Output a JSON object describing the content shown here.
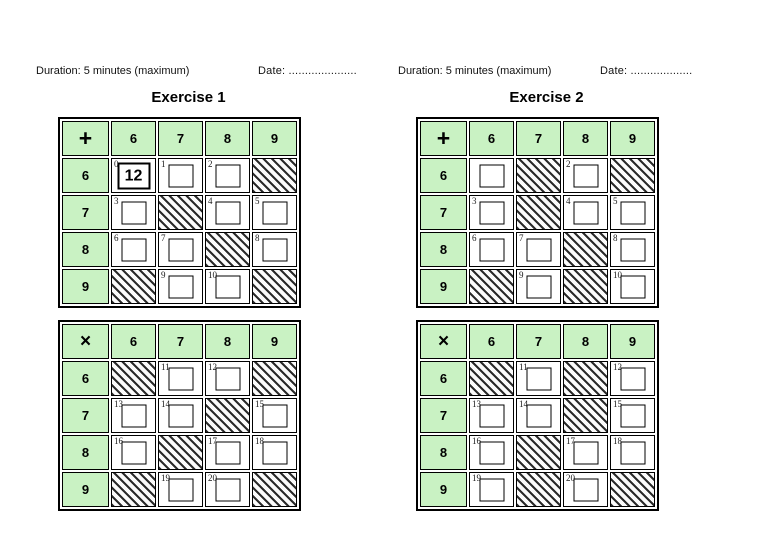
{
  "colors": {
    "header_green": "#c9f2c3",
    "grid_border": "#000000",
    "hatch_stripe": "#2b2b2b"
  },
  "exercises": [
    {
      "duration": "Duration: 5 minutes (maximum)",
      "date": "Date: .....................",
      "title": "Exercise 1",
      "grids": [
        {
          "name": "addition",
          "operator": "+",
          "col_headers": [
            "6",
            "7",
            "8",
            "9"
          ],
          "rows": [
            {
              "header": "6",
              "cells": [
                {
                  "type": "box",
                  "label": "0",
                  "value": "12"
                },
                {
                  "type": "box",
                  "label": "1"
                },
                {
                  "type": "box",
                  "label": "2"
                },
                {
                  "type": "hatch"
                }
              ]
            },
            {
              "header": "7",
              "cells": [
                {
                  "type": "box",
                  "label": "3"
                },
                {
                  "type": "hatch"
                },
                {
                  "type": "box",
                  "label": "4"
                },
                {
                  "type": "box",
                  "label": "5"
                }
              ]
            },
            {
              "header": "8",
              "cells": [
                {
                  "type": "box",
                  "label": "6"
                },
                {
                  "type": "box",
                  "label": "7"
                },
                {
                  "type": "hatch"
                },
                {
                  "type": "box",
                  "label": "8"
                }
              ]
            },
            {
              "header": "9",
              "cells": [
                {
                  "type": "hatch"
                },
                {
                  "type": "box",
                  "label": "9"
                },
                {
                  "type": "box",
                  "label": "10"
                },
                {
                  "type": "hatch"
                }
              ]
            }
          ]
        },
        {
          "name": "multiplication",
          "operator": "×",
          "col_headers": [
            "6",
            "7",
            "8",
            "9"
          ],
          "rows": [
            {
              "header": "6",
              "cells": [
                {
                  "type": "hatch"
                },
                {
                  "type": "box",
                  "label": "11"
                },
                {
                  "type": "box",
                  "label": "12"
                },
                {
                  "type": "hatch"
                }
              ]
            },
            {
              "header": "7",
              "cells": [
                {
                  "type": "box",
                  "label": "13"
                },
                {
                  "type": "box",
                  "label": "14"
                },
                {
                  "type": "hatch"
                },
                {
                  "type": "box",
                  "label": "15"
                }
              ]
            },
            {
              "header": "8",
              "cells": [
                {
                  "type": "box",
                  "label": "16"
                },
                {
                  "type": "hatch"
                },
                {
                  "type": "box",
                  "label": "17"
                },
                {
                  "type": "box",
                  "label": "18"
                }
              ]
            },
            {
              "header": "9",
              "cells": [
                {
                  "type": "hatch"
                },
                {
                  "type": "box",
                  "label": "19"
                },
                {
                  "type": "box",
                  "label": "20"
                },
                {
                  "type": "hatch"
                }
              ]
            }
          ]
        }
      ]
    },
    {
      "duration": "Duration: 5 minutes (maximum)",
      "date": "Date: ...................",
      "title": "Exercise 2",
      "grids": [
        {
          "name": "addition",
          "operator": "+",
          "col_headers": [
            "6",
            "7",
            "8",
            "9"
          ],
          "rows": [
            {
              "header": "6",
              "cells": [
                {
                  "type": "box"
                },
                {
                  "type": "hatch"
                },
                {
                  "type": "box",
                  "label": "2"
                },
                {
                  "type": "hatch"
                }
              ]
            },
            {
              "header": "7",
              "cells": [
                {
                  "type": "box",
                  "label": "3"
                },
                {
                  "type": "hatch"
                },
                {
                  "type": "box",
                  "label": "4"
                },
                {
                  "type": "box",
                  "label": "5"
                }
              ]
            },
            {
              "header": "8",
              "cells": [
                {
                  "type": "box",
                  "label": "6"
                },
                {
                  "type": "box",
                  "label": "7"
                },
                {
                  "type": "hatch"
                },
                {
                  "type": "box",
                  "label": "8"
                }
              ]
            },
            {
              "header": "9",
              "cells": [
                {
                  "type": "hatch"
                },
                {
                  "type": "box",
                  "label": "9"
                },
                {
                  "type": "hatch"
                },
                {
                  "type": "box",
                  "label": "10"
                }
              ]
            }
          ]
        },
        {
          "name": "multiplication",
          "operator": "×",
          "col_headers": [
            "6",
            "7",
            "8",
            "9"
          ],
          "rows": [
            {
              "header": "6",
              "cells": [
                {
                  "type": "hatch"
                },
                {
                  "type": "box",
                  "label": "11"
                },
                {
                  "type": "hatch"
                },
                {
                  "type": "box",
                  "label": "12"
                }
              ]
            },
            {
              "header": "7",
              "cells": [
                {
                  "type": "box",
                  "label": "13"
                },
                {
                  "type": "box",
                  "label": "14"
                },
                {
                  "type": "hatch"
                },
                {
                  "type": "box",
                  "label": "15"
                }
              ]
            },
            {
              "header": "8",
              "cells": [
                {
                  "type": "box",
                  "label": "16"
                },
                {
                  "type": "hatch"
                },
                {
                  "type": "box",
                  "label": "17"
                },
                {
                  "type": "box",
                  "label": "18"
                }
              ]
            },
            {
              "header": "9",
              "cells": [
                {
                  "type": "box",
                  "label": "19"
                },
                {
                  "type": "hatch"
                },
                {
                  "type": "box",
                  "label": "20"
                },
                {
                  "type": "hatch"
                }
              ]
            }
          ]
        }
      ]
    }
  ]
}
